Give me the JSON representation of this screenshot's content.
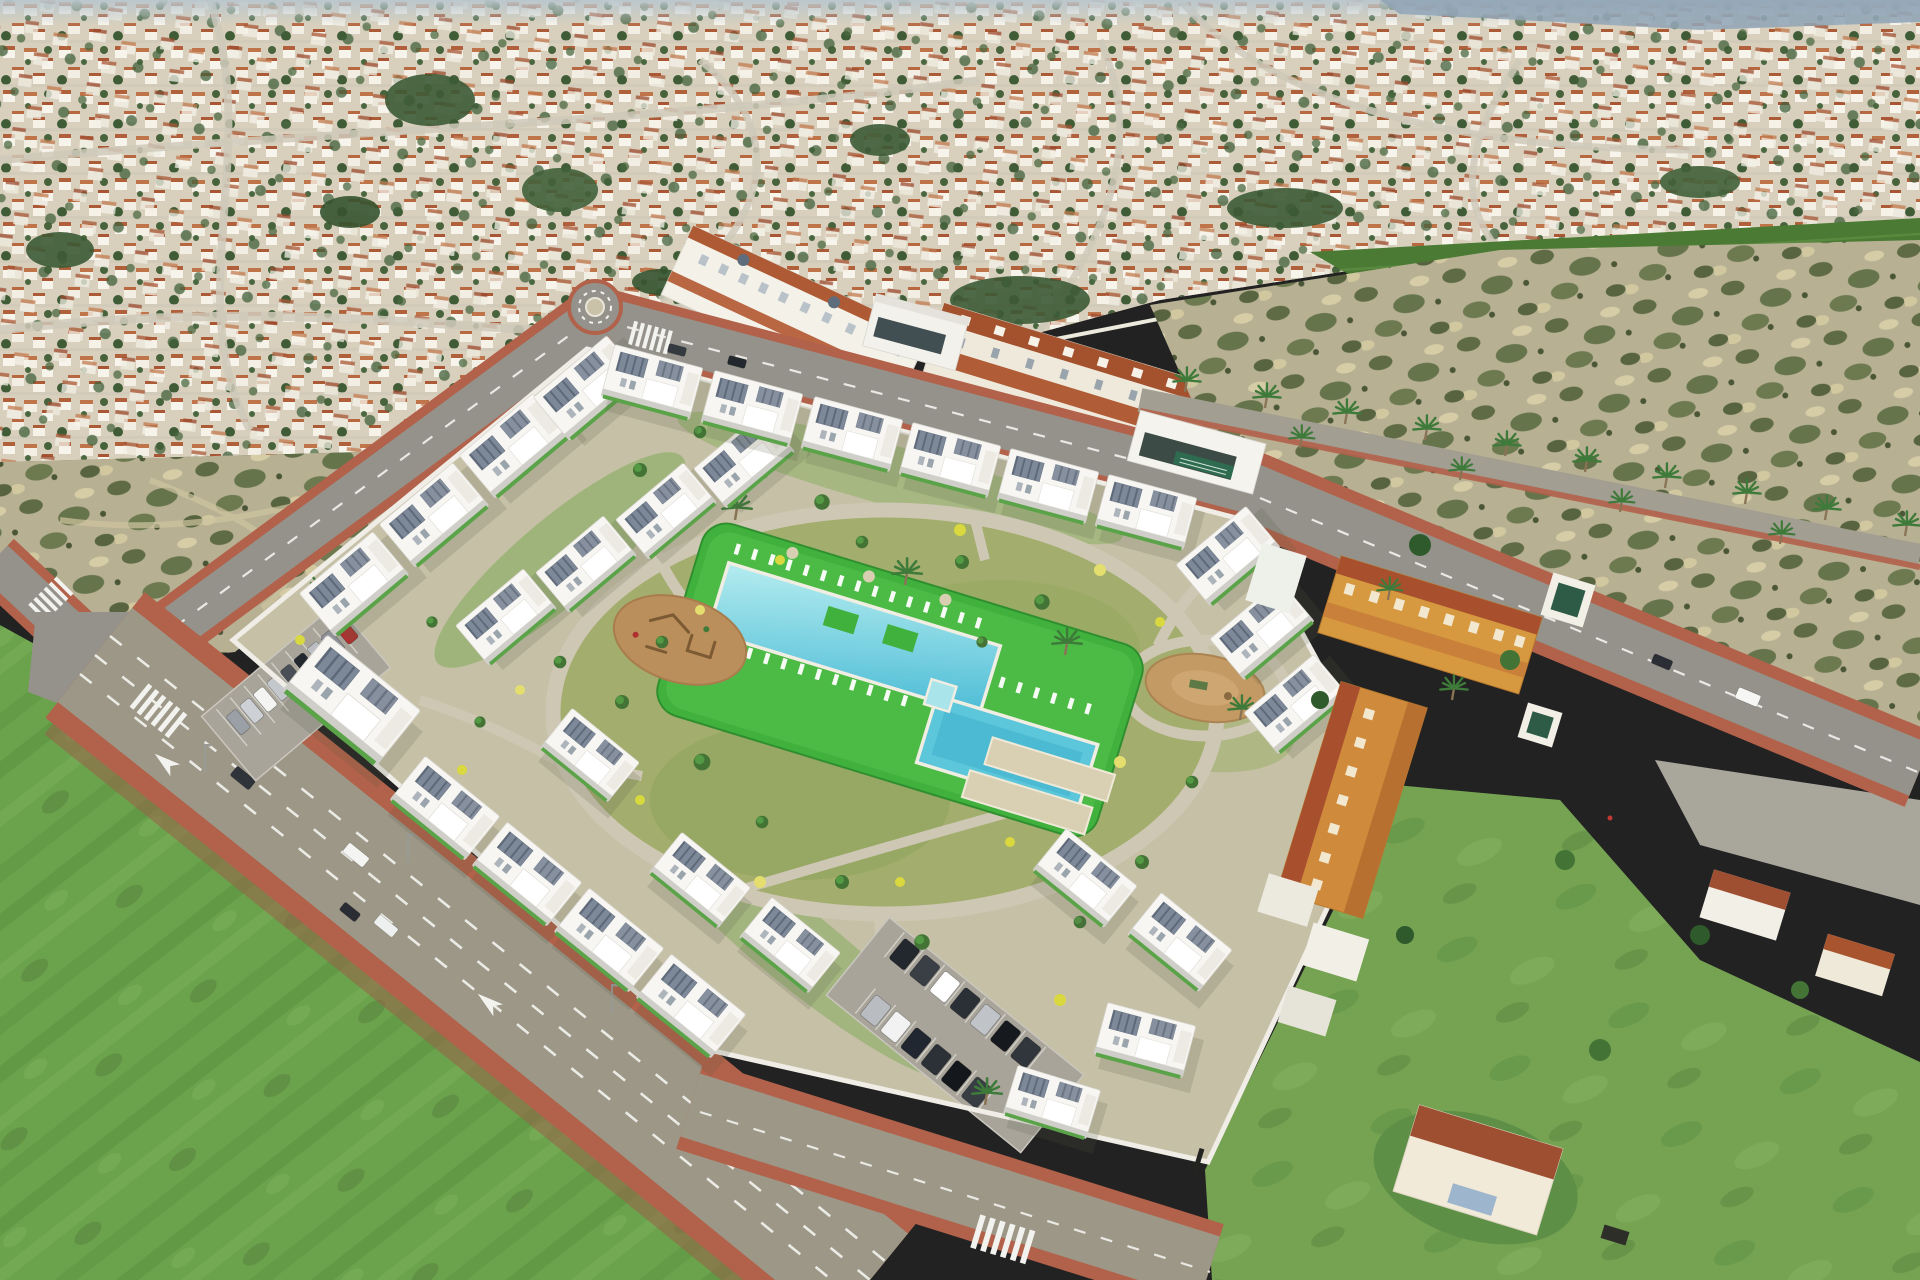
{
  "meta": {
    "title": "Aerial drone view of a new-build residential complex (CGI render) inside an existing Spanish coastal town",
    "description": "Bird's-eye photo: dense white-and-terracotta town at top, a new gated development of white cubic apartment blocks with solar roofs around a central garden with two turquoise pools, sun loungers, playground and dog park; scrubland plots, bright green fields and roads with red-brick sidewalks, crosswalks and cars."
  },
  "palette": {
    "haze": "#b9c6cd",
    "hills": "#8fa3b5",
    "town_base": "#d8d0bd",
    "farm_green": "#4a7a33",
    "scrub_base": "#b7b093",
    "field_left": "#6ba24c",
    "field_right": "#75a352",
    "asphalt": "#94928a",
    "asphalt_warm": "#9d9787",
    "sidewalk_red": "#b2614a",
    "line_white": "#f2f2ee",
    "plot_base": "#c6c0a6",
    "path_gray": "#cdc7b3",
    "lawn_bright": "#41b13e",
    "lawn_mid": "#7fa958",
    "pool_light": "#a8e4ea",
    "pool_mid": "#5cc6da",
    "pool_deep": "#3fb0cc",
    "deck_white": "#f0ede2",
    "building_white": "#f7f6f2",
    "wall_white": "#efede6",
    "village_orange": "#d6993f",
    "village_terracotta": "#a8502e",
    "village_white": "#f2efe6",
    "village_green_roof": "#2e5b46",
    "dirt_playground": "#bb8f5c",
    "dirt_dogpark": "#c39a63",
    "petanque_sand": "#d9d0b4",
    "roundabout_center": "#c9c2a8",
    "embankment": "#9b6148"
  },
  "scene": {
    "development": {
      "label": "new residential complex",
      "apartment_blocks": 30,
      "style": "white cubic blocks with rooftop solar panels and green lawn edging",
      "perimeter": "white wall"
    },
    "amenities": {
      "pools": 2,
      "kids_pool": 1,
      "pool_islands": 2,
      "sun_loungers": 33,
      "parasols": 3,
      "playground": "sand playground with wooden climbing frames",
      "dog_park": "oval dirt dog park",
      "petanque_courts": 2
    },
    "parking_west": {
      "cars": [
        "#9aa0a6",
        "#cdd0d4",
        "#f4f4f2",
        "#c4c7cc",
        "#4a4f57",
        "#23272e",
        "#babdc2",
        "#8e9298",
        "#b03030"
      ]
    },
    "parking_south": {
      "cars_row1": [
        "#23272e",
        "#3a3f46",
        "#ffffff",
        "#2b3036",
        "#c0c3c8",
        "#16191d",
        "#31363d"
      ],
      "cars_row2": [
        "#b9bcc1",
        "#f2f2f2",
        "#202730",
        "#2c3138",
        "#14171b",
        "#383d44"
      ]
    },
    "roads": {
      "main_road": {
        "cars": [
          {
            "color": "#2f333a",
            "type": "suv"
          },
          {
            "color": "#f4f4f2",
            "type": "van"
          },
          {
            "color": "#2a2e34",
            "type": "car"
          },
          {
            "color": "#eef0f0",
            "type": "minivan"
          }
        ],
        "markings": "white dashed lanes, direction arrows, zebra crossings"
      },
      "top_road": {
        "cars": [
          {
            "color": "#343a40"
          },
          {
            "color": "#23282e"
          },
          {
            "color": "#f6f6f4"
          }
        ]
      },
      "east_road": {
        "cars": [
          {
            "color": "#f6f6f4"
          },
          {
            "color": "#2b2f35"
          }
        ],
        "feature": "palm-lined avenue"
      }
    },
    "surroundings": {
      "town": "dense suburb of white villas with terracotta roofs and dark green trees",
      "townhouse_row": "white townhouses with terracotta roofs above the top road",
      "village_east": "existing orange and white townhouses with terracotta and green pyramid roofs",
      "scrubland": "two undeveloped scrub plots",
      "fields": "two bright green fields in the foreground",
      "farm_strip": "green farmland strip at upper right",
      "horizon": "hazy blue hills at top right"
    }
  }
}
